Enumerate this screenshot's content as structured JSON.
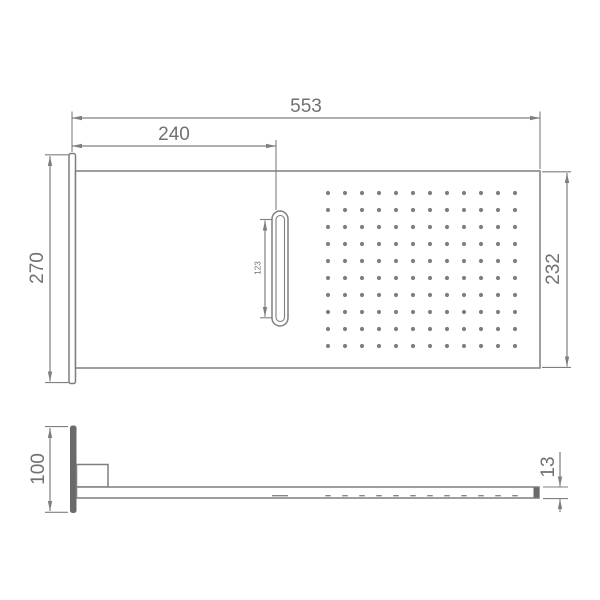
{
  "drawing": {
    "type": "technical-dimension-drawing",
    "subject": "wall-mounted rectangular shower head with waterfall slot, front view and side profile view"
  },
  "dimensions": {
    "front": {
      "overall_width": "553",
      "slot_offset": "240",
      "flange_height": "270",
      "faceplate_height": "232",
      "slot_length": "123"
    },
    "side": {
      "flange_height": "100",
      "plate_thickness": "13"
    }
  },
  "holes": {
    "rows": 10,
    "cols": 12,
    "x0": 328,
    "y0": 193,
    "dx": 17,
    "dy": 17,
    "r": 2.1
  },
  "hidden_dashes": {
    "y": 495.7,
    "slot_dash": {
      "x1": 272,
      "x2": 288
    },
    "hole_dashes": {
      "x0": 328,
      "dx": 17,
      "count": 12,
      "len": 5.5
    }
  },
  "colors": {
    "line": "#7f7f7f",
    "dim_line": "#868686",
    "text": "#717171",
    "dark_fill": "#6a6a6a",
    "background": "#ffffff"
  }
}
